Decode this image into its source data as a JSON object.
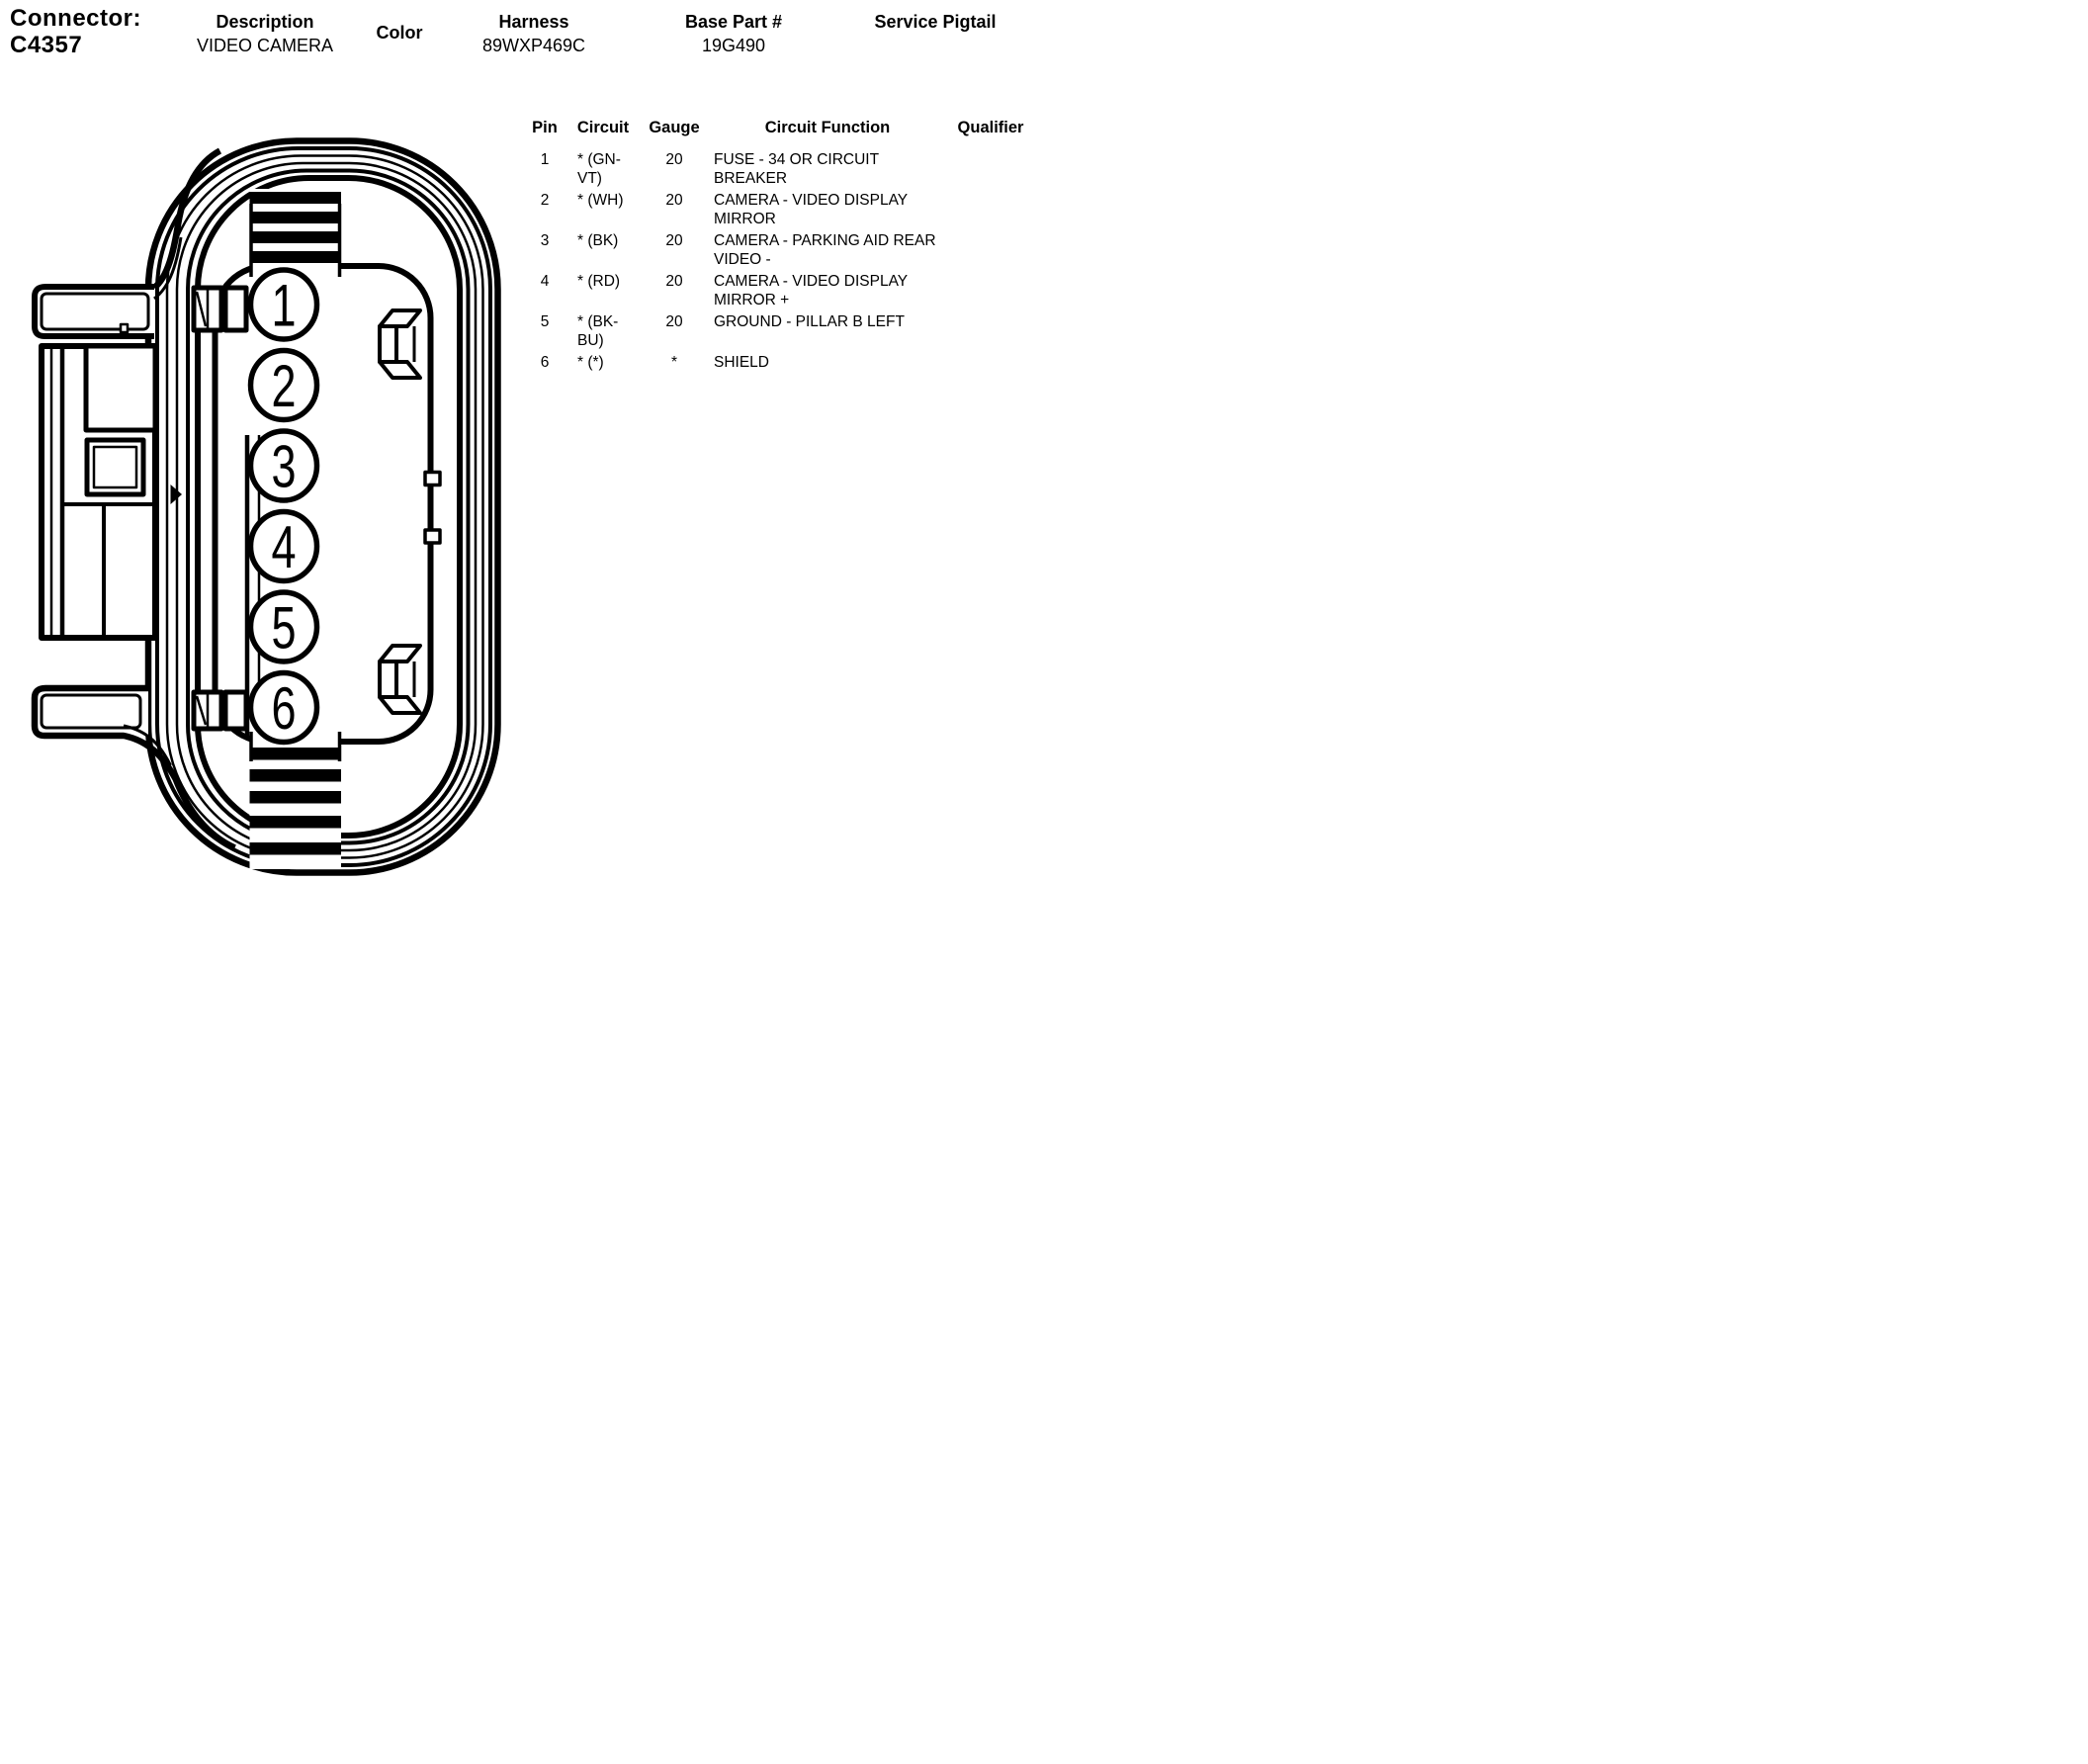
{
  "header": {
    "connector_label": "Connector:",
    "connector_id": "C4357",
    "fields": [
      {
        "label": "Description",
        "value": "VIDEO CAMERA"
      },
      {
        "label": "Color",
        "value": ""
      },
      {
        "label": "Harness",
        "value": "89WXP469C"
      },
      {
        "label": "Base Part #",
        "value": "19G490"
      },
      {
        "label": "Service Pigtail",
        "value": ""
      }
    ]
  },
  "pin_table": {
    "columns": [
      "Pin",
      "Circuit",
      "Gauge",
      "Circuit Function",
      "Qualifier"
    ],
    "rows": [
      {
        "pin": "1",
        "circuit": "* (GN-VT)",
        "gauge": "20",
        "function": "FUSE - 34 OR CIRCUIT BREAKER",
        "qualifier": ""
      },
      {
        "pin": "2",
        "circuit": "* (WH)",
        "gauge": "20",
        "function": "CAMERA - VIDEO DISPLAY MIRROR",
        "qualifier": ""
      },
      {
        "pin": "3",
        "circuit": "* (BK)",
        "gauge": "20",
        "function": "CAMERA - PARKING AID REAR VIDEO -",
        "qualifier": ""
      },
      {
        "pin": "4",
        "circuit": "* (RD)",
        "gauge": "20",
        "function": "CAMERA - VIDEO DISPLAY MIRROR +",
        "qualifier": ""
      },
      {
        "pin": "5",
        "circuit": "* (BK-BU)",
        "gauge": "20",
        "function": "GROUND - PILLAR B LEFT",
        "qualifier": ""
      },
      {
        "pin": "6",
        "circuit": "* (*)",
        "gauge": "*",
        "function": "SHIELD",
        "qualifier": ""
      }
    ]
  },
  "diagram": {
    "description": "6-pin connector face view, line drawing",
    "pins": [
      "1",
      "2",
      "3",
      "4",
      "5",
      "6"
    ],
    "line_color": "#000000",
    "background_color": "#ffffff"
  }
}
